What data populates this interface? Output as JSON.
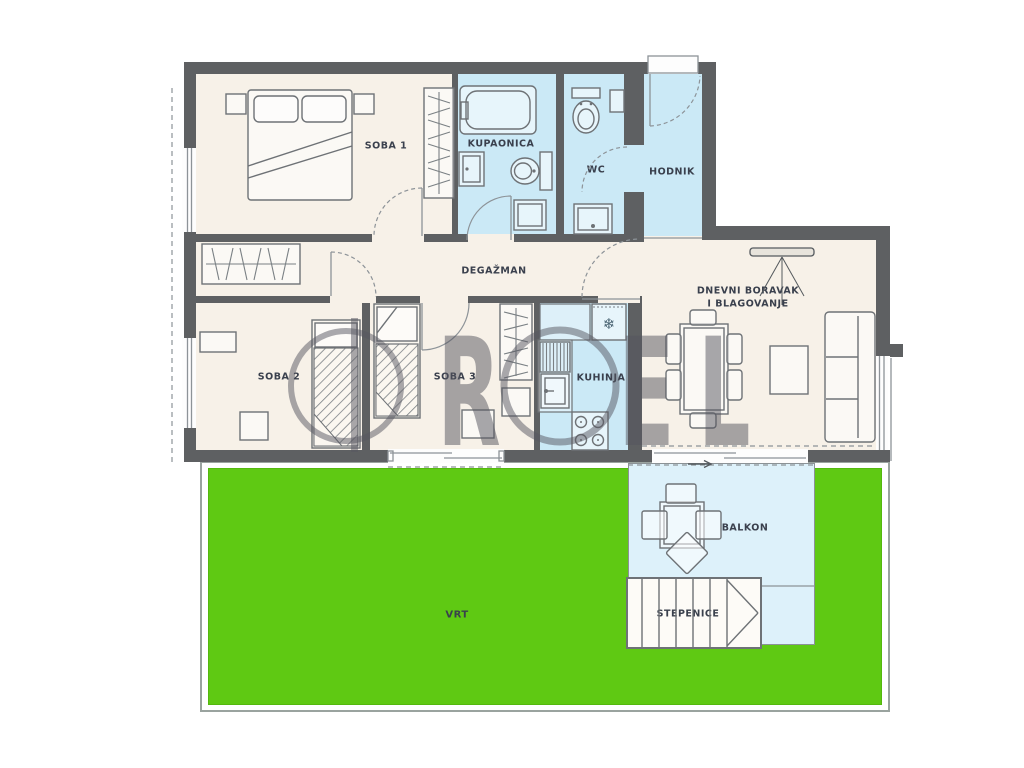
{
  "plan": {
    "labels": {
      "soba1": "SOBA 1",
      "kupaonica": "KUPAONICA",
      "wc": "WC",
      "hodnik": "HODNIK",
      "degazman": "DEGAŽMAN",
      "soba2": "SOBA 2",
      "soba3": "SOBA 3",
      "kuhinja": "KUHINJA",
      "dnevni_line1": "DNEVNI BORAVAK",
      "dnevni_line2": "I BLAGOVANJE",
      "balkon": "BALKON",
      "stepenice": "STEPENICE",
      "vrt": "VRT"
    },
    "watermark": {
      "letter_r": "R",
      "letter_e": "E",
      "letter_l": "L"
    },
    "icons": {
      "snowflake": "❄"
    },
    "colors": {
      "wall": "#5e6062",
      "floor": "#f7f1e8",
      "wet-room": "#cbe9f6",
      "balcony": "#ddf1fa",
      "garden": "#5fc913",
      "stairs-fill": "#fdfbf7",
      "label": "#3a404d",
      "watermark": "#55555f",
      "line": "#6e7276"
    }
  }
}
